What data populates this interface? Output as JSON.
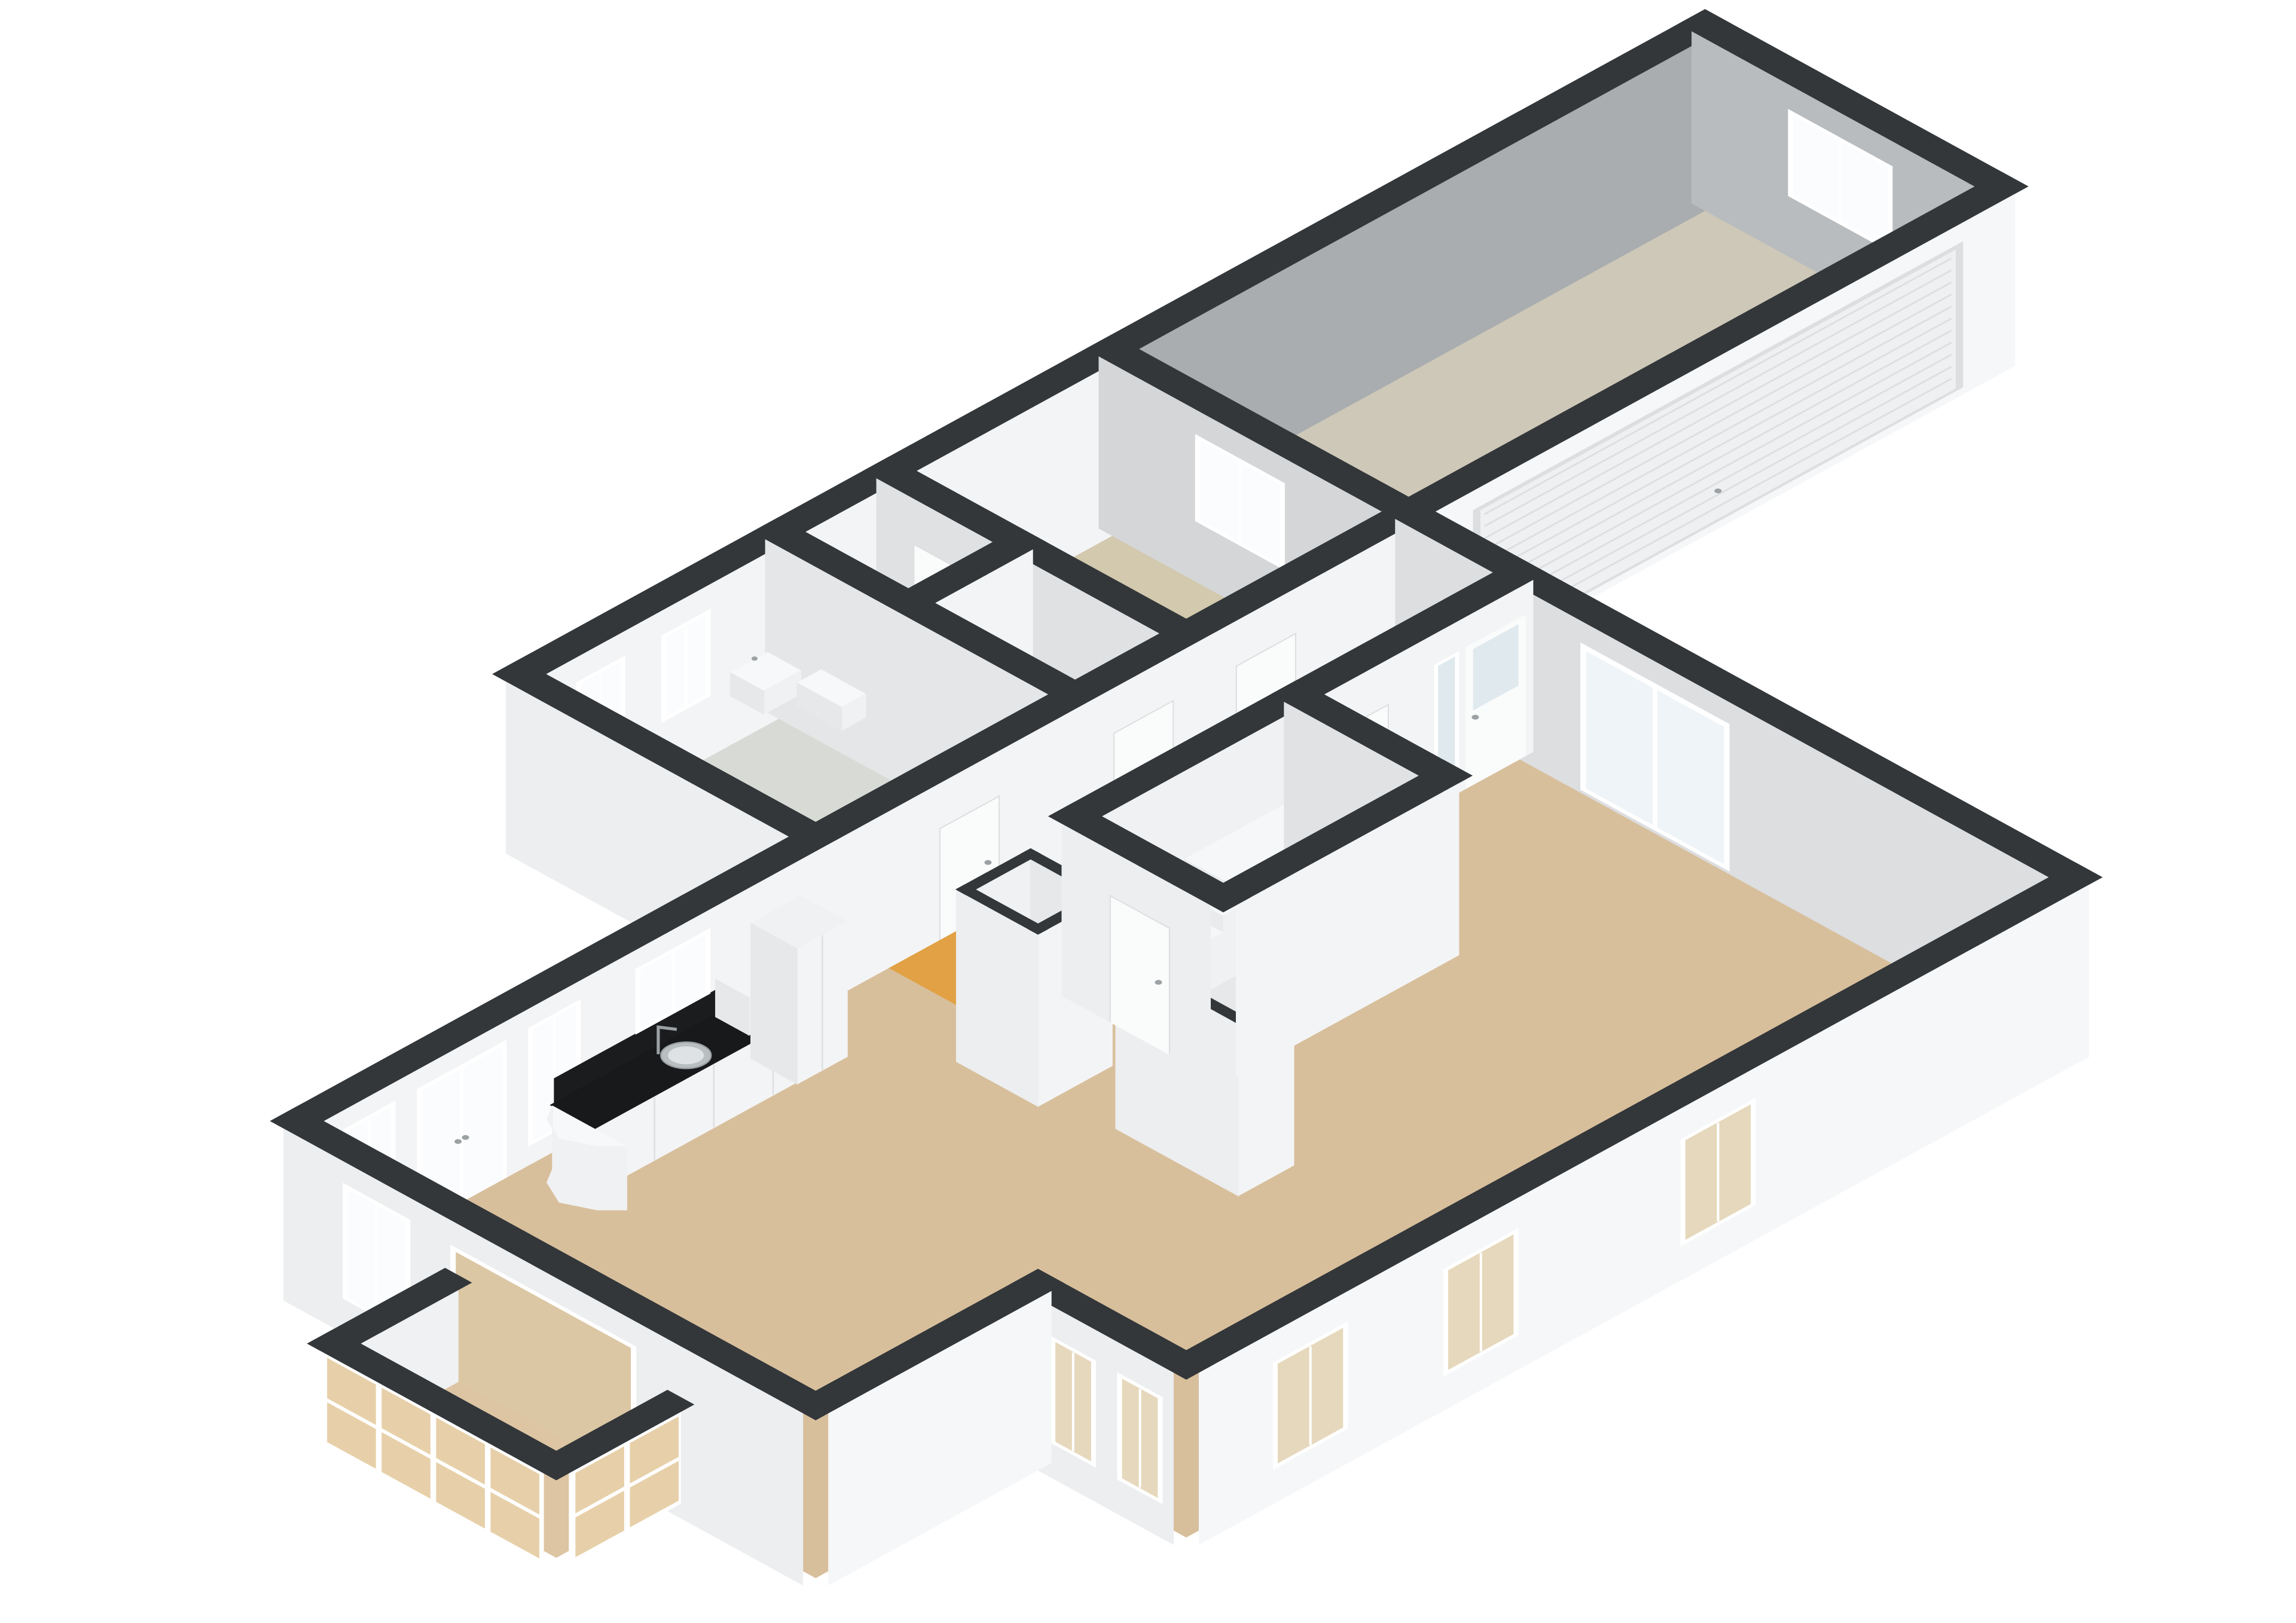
{
  "scene": {
    "type": "3d-floorplan-isometric-render",
    "background": "#ffffff",
    "wall_cap_color": "#33373a"
  },
  "palette": {
    "cap": "#33373a",
    "extS": "#f6f7f8",
    "intS": "#f3f4f5",
    "extW": "#eceeef",
    "intW": "#e0e2e4",
    "wallWhite": "#fafbfb",
    "garage_n": "#a9adaf",
    "garage_e": "#b8bcbe",
    "bedroom_e": "#d4d6d8",
    "partition_w": "#dfe1e3",
    "bath_e": "#e4e6e7",
    "eastmain_w": "#dcdee0",
    "counter_top": "#17191b",
    "backsplash": "#1a1c1e",
    "steel": "#b9bec1",
    "steel_dark": "#9ca1a4",
    "pane_lit": "#fbfcfd",
    "pane_soft": "#eef4f7",
    "pane_thru": "#e6d8bc",
    "pane_bay": "#e7d0a9",
    "pane_entry": "#dfe9ee",
    "pane_open": "#dcc7a4",
    "frame": "#ffffff",
    "rib": "#dcdedf",
    "roller": "#eef0f1",
    "seam": "#dcdee0",
    "fix_top": "#f7f8f9",
    "fix_face": "#f0f1f2",
    "fix_side": "#e6e8ea",
    "step_face": "#e9ebec",
    "step_top": "#f6f7f8",
    "handle": "#9ca1a4",
    "bowl_stroke": "#cdd0d2",
    "bowl_fill": "#fafbfc",
    "bowl_inner": "#eef0f1"
  },
  "rooms": [
    {
      "id": "living",
      "label": "living-room",
      "floor": "#d8bf9c"
    },
    {
      "id": "hall",
      "label": "hallway-stairs",
      "floor": "#e1a144"
    },
    {
      "id": "bathroom",
      "label": "bathroom",
      "floor": "#d8dbd5"
    },
    {
      "id": "lobby",
      "label": "bedroom-lobby",
      "floor": "#d2c8ad"
    },
    {
      "id": "bedroom",
      "label": "bedroom",
      "floor": "#d2c9ae"
    },
    {
      "id": "garage",
      "label": "garage",
      "floor": "#cec8b8"
    },
    {
      "id": "bay",
      "label": "conservatory-bay",
      "floor": "#ddc5a3"
    }
  ],
  "fixtures": [
    "kitchen-counter",
    "kitchen-sink",
    "kitchen-faucet",
    "tall-cabinet",
    "counter-appliance",
    "bathroom-vanity",
    "wall-basin",
    "toilet",
    "staircase",
    "roller-garage-door",
    "entrance-door",
    "sliding-glass-door",
    "french-doors",
    "interior-doors",
    "windows",
    "conservatory-glazing",
    "duct-shafts"
  ]
}
